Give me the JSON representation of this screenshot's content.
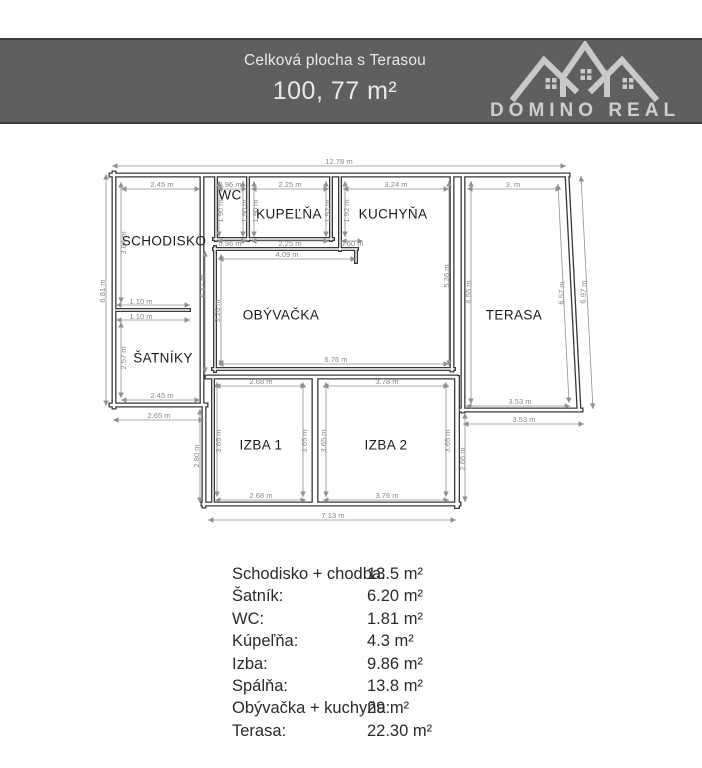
{
  "header": {
    "subtitle": "Celková plocha s Terasou",
    "total_area": "100, 77 m²",
    "brand": "DOMINO REAL"
  },
  "floorplan": {
    "wall_color": "#383838",
    "dim_color": "#909090",
    "rooms": [
      {
        "label": "SCHODISKO",
        "x": 164,
        "y": 242
      },
      {
        "label": "WC",
        "x": 230,
        "y": 196
      },
      {
        "label": "KUPEĽŇA",
        "x": 289,
        "y": 215
      },
      {
        "label": "KUCHYŇA",
        "x": 393,
        "y": 215
      },
      {
        "label": "OBÝVAČKA",
        "x": 281,
        "y": 316
      },
      {
        "label": "TERASA",
        "x": 514,
        "y": 316
      },
      {
        "label": "ŠATNÍKY",
        "x": 163,
        "y": 359
      },
      {
        "label": "IZBA 1",
        "x": 261,
        "y": 446
      },
      {
        "label": "IZBA 2",
        "x": 386,
        "y": 446
      }
    ],
    "dimensions": [
      {
        "label": "12.78 m",
        "x": 339,
        "y": 162,
        "rot": 0,
        "line": [
          112,
          166,
          566,
          166
        ]
      },
      {
        "label": "2.45 m",
        "x": 162,
        "y": 185,
        "rot": 0,
        "line": [
          121,
          189,
          200,
          189
        ]
      },
      {
        "label": "0.96 m",
        "x": 230,
        "y": 185,
        "rot": 0,
        "line": [
          217,
          189,
          247,
          189
        ]
      },
      {
        "label": "2.25 m",
        "x": 290,
        "y": 185,
        "rot": 0,
        "line": [
          251,
          189,
          329,
          189
        ]
      },
      {
        "label": "3.24 m",
        "x": 396,
        "y": 185,
        "rot": 0,
        "line": [
          343,
          189,
          449,
          189
        ]
      },
      {
        "label": "3.  m",
        "x": 513,
        "y": 185,
        "rot": 0,
        "line": [
          467,
          189,
          561,
          189
        ]
      },
      {
        "label": "0.96 m",
        "x": 230,
        "y": 244,
        "rot": 0,
        "line": [
          217,
          241,
          247,
          241
        ]
      },
      {
        "label": "2.25 m",
        "x": 290,
        "y": 244,
        "rot": 0,
        "line": [
          251,
          241,
          329,
          241
        ]
      },
      {
        "label": "0.60 m",
        "x": 352,
        "y": 244,
        "rot": 0,
        "line": [
          341,
          241,
          363,
          241
        ]
      },
      {
        "label": "4.09 m",
        "x": 287,
        "y": 255,
        "rot": 0,
        "line": [
          218,
          259,
          356,
          259
        ]
      },
      {
        "label": "1.10 m",
        "x": 141,
        "y": 302,
        "rot": 0,
        "line": [
          116,
          305,
          190,
          305
        ]
      },
      {
        "label": "1.10 m",
        "x": 141,
        "y": 317,
        "rot": 0,
        "line": [
          116,
          320,
          190,
          320
        ]
      },
      {
        "label": "6.76 m",
        "x": 336,
        "y": 360,
        "rot": 0,
        "line": [
          218,
          364,
          449,
          364
        ]
      },
      {
        "label": "2.45 m",
        "x": 162,
        "y": 396,
        "rot": 0,
        "line": [
          121,
          400,
          200,
          400
        ]
      },
      {
        "label": "2.65 m",
        "x": 159,
        "y": 416,
        "rot": 0,
        "line": [
          113,
          420,
          204,
          420
        ]
      },
      {
        "label": "2.68 m",
        "x": 261,
        "y": 382,
        "rot": 0,
        "line": [
          215,
          386,
          306,
          386
        ]
      },
      {
        "label": "3.78 m",
        "x": 387,
        "y": 382,
        "rot": 0,
        "line": [
          323,
          386,
          449,
          386
        ]
      },
      {
        "label": "3.53 m",
        "x": 520,
        "y": 402,
        "rot": 0,
        "line": [
          466,
          406,
          570,
          406
        ]
      },
      {
        "label": "3.53 m",
        "x": 524,
        "y": 420,
        "rot": 0,
        "line": [
          463,
          424,
          584,
          424
        ]
      },
      {
        "label": "2.68 m",
        "x": 261,
        "y": 496,
        "rot": 0,
        "line": [
          215,
          500,
          306,
          500
        ]
      },
      {
        "label": "3.76 m",
        "x": 387,
        "y": 496,
        "rot": 0,
        "line": [
          323,
          500,
          449,
          500
        ]
      },
      {
        "label": "7.13 m",
        "x": 333,
        "y": 516,
        "rot": 0,
        "line": [
          208,
          520,
          456,
          520
        ]
      },
      {
        "label": "6.81 m",
        "x": 103,
        "y": 291,
        "rot": -90,
        "line": [
          106,
          174,
          106,
          406
        ]
      },
      {
        "label": "3.64 m",
        "x": 124,
        "y": 243,
        "rot": -90,
        "line": [
          121,
          182,
          121,
          303
        ]
      },
      {
        "label": "2.57 m",
        "x": 124,
        "y": 358,
        "rot": -90,
        "line": [
          121,
          322,
          121,
          398
        ]
      },
      {
        "label": "1.90 m",
        "x": 221,
        "y": 211,
        "rot": -90,
        "line": [
          219,
          181,
          219,
          237
        ]
      },
      {
        "label": "1.90 m",
        "x": 245,
        "y": 211,
        "rot": -90,
        "line": [
          243,
          181,
          243,
          237
        ]
      },
      {
        "label": "1.90 m",
        "x": 256,
        "y": 211,
        "rot": -90,
        "line": [
          254,
          181,
          254,
          237
        ]
      },
      {
        "label": "1.92 m",
        "x": 328,
        "y": 211,
        "rot": -90,
        "line": [
          326,
          181,
          326,
          237
        ]
      },
      {
        "label": "1.92 m",
        "x": 347,
        "y": 211,
        "rot": -90,
        "line": [
          345,
          181,
          345,
          237
        ]
      },
      {
        "label": "6.41 m",
        "x": 203,
        "y": 286,
        "rot": -90,
        "line": [
          205,
          251,
          205,
          373
        ]
      },
      {
        "label": "3.26 m",
        "x": 218,
        "y": 311,
        "rot": -90,
        "line": [
          221,
          254,
          221,
          366
        ]
      },
      {
        "label": "5.36 m",
        "x": 447,
        "y": 276,
        "rot": -90,
        "line": [
          449,
          181,
          449,
          366
        ]
      },
      {
        "label": "6.55 m",
        "x": 469,
        "y": 292,
        "rot": -90,
        "line": [
          471,
          181,
          471,
          404
        ]
      },
      {
        "label": "6.57 m",
        "x": 562,
        "y": 293,
        "rot": -87,
        "line": [
          558,
          184,
          569,
          403
        ]
      },
      {
        "label": "6.97 m",
        "x": 584,
        "y": 292,
        "rot": -87,
        "line": [
          581,
          176,
          593,
          409
        ]
      },
      {
        "label": "2.80 m",
        "x": 197,
        "y": 456,
        "rot": -90,
        "line": [
          200,
          409,
          200,
          503
        ]
      },
      {
        "label": "3.65 m",
        "x": 219,
        "y": 441,
        "rot": -90,
        "line": [
          217,
          382,
          217,
          497
        ]
      },
      {
        "label": "3.65 m",
        "x": 305,
        "y": 441,
        "rot": -90,
        "line": [
          303,
          382,
          303,
          497
        ]
      },
      {
        "label": "3.65 m",
        "x": 324,
        "y": 441,
        "rot": -90,
        "line": [
          326,
          382,
          326,
          497
        ]
      },
      {
        "label": "3.65 m",
        "x": 448,
        "y": 441,
        "rot": -90,
        "line": [
          446,
          382,
          446,
          497
        ]
      },
      {
        "label": "2.66 m",
        "x": 463,
        "y": 459,
        "rot": -90,
        "line": [
          465,
          413,
          465,
          502
        ]
      }
    ]
  },
  "areas": {
    "rows": [
      {
        "label": "Schodisko + chodba:",
        "value": "13.5 m²"
      },
      {
        "label": "Šatník:",
        "value": "6.20 m²"
      },
      {
        "label": "WC:",
        "value": "1.81 m²"
      },
      {
        "label": "Kúpeľňa:",
        "value": "4.3 m²"
      },
      {
        "label": "Izba:",
        "value": "9.86 m²"
      },
      {
        "label": "Spálňa:",
        "value": "13.8 m²"
      },
      {
        "label": "Obývačka + kuchyňa:",
        "value": "29 m²"
      },
      {
        "label": "Terasa:",
        "value": "22.30 m²"
      }
    ]
  }
}
